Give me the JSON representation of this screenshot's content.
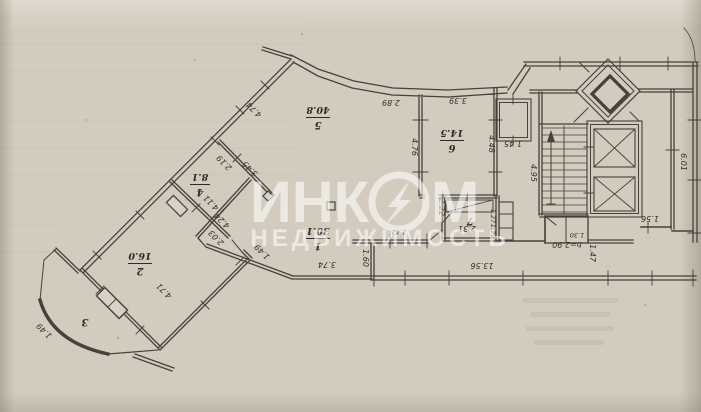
{
  "colors": {
    "paper": "#d2cbbe",
    "ink": "#46413a",
    "watermark": "#ffffff"
  },
  "watermark": {
    "line1_left": "ИНК",
    "line1_right": "М",
    "line2": "НЕДВИЖИМОСТЬ",
    "logo": "lightning-bolt-in-circle"
  },
  "plan": {
    "rooms": [
      {
        "number": "1",
        "area": "30.1"
      },
      {
        "number": "2",
        "area": "16.0"
      },
      {
        "number": "3",
        "area": ""
      },
      {
        "number": "4",
        "area": "8.1"
      },
      {
        "number": "5",
        "area": "40.8"
      },
      {
        "number": "6",
        "area": "14.5"
      },
      {
        "number": "7",
        "area": ""
      }
    ],
    "ceiling_height": "h=2.90",
    "dimensions": {
      "top_diagonal_wall": "4.74",
      "top_curved_wall": "2.89",
      "room6_top_wall": "3.39",
      "room4_room5_partition_a": "2.19",
      "room4_room5_partition_b": "3.45",
      "room4_room1_wall_a": "4.11",
      "room4_room1_wall_b": "4.24",
      "room1_sw_wall_a": "2.03",
      "room1_sw_wall_b": "1.49",
      "room1_bottom_wall": "3.74",
      "room2_wall": "4.71",
      "balcony_wall": "1.49",
      "corridor_jog": "1.60",
      "corridor_length": "13.56",
      "room5_room6_partition": "4.76",
      "room6_right_wall": "4.48",
      "shaft_width": "1.45",
      "staircase_depth": "4.95",
      "right_side_wall": "6.01",
      "right_stub": "1.56",
      "lobby_depth": "1.47",
      "lobby_small": "1.30",
      "hall_wall": "2.22",
      "room7_width": "2.31",
      "room7_depth_a": "1.27",
      "room7_depth_b": "1.22",
      "hall_niche": "1.42"
    }
  }
}
